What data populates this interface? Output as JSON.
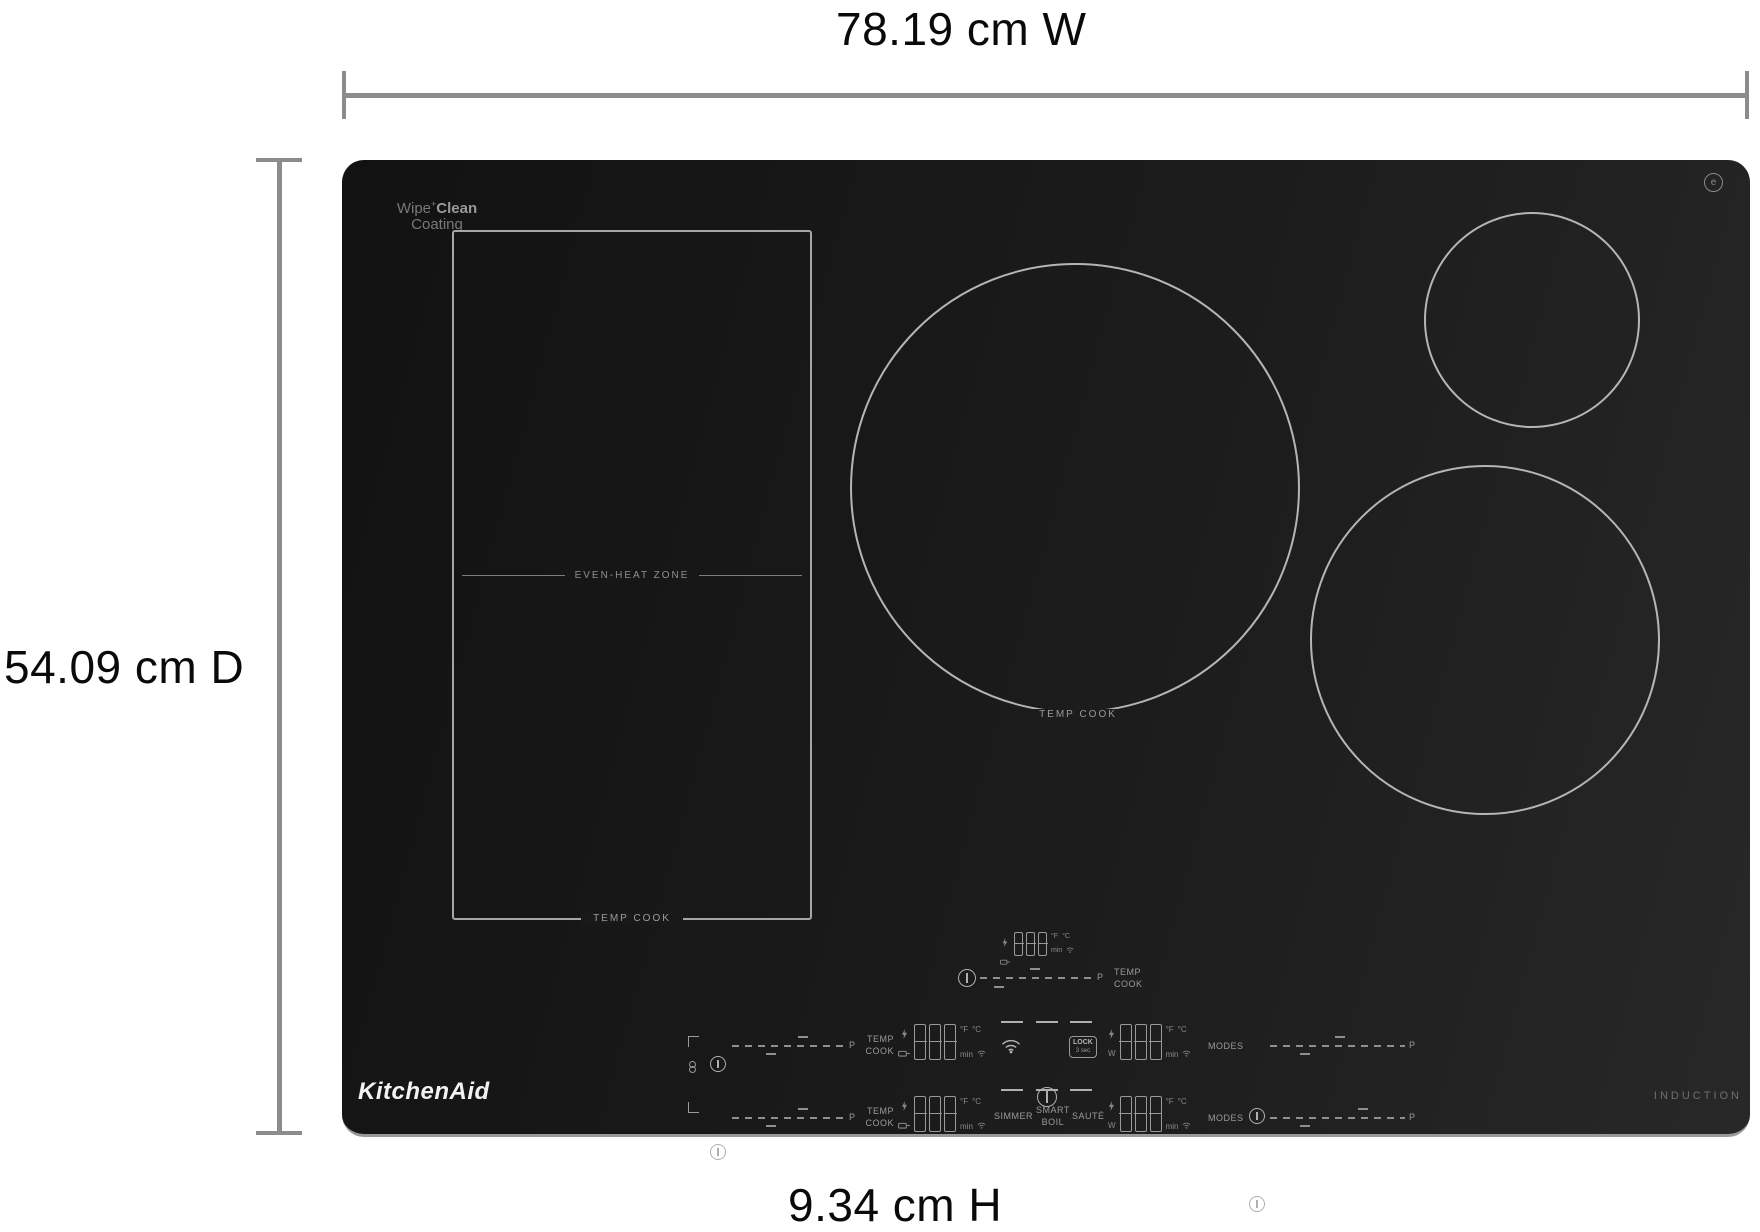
{
  "dimensions": {
    "width_label": "78.19 cm W",
    "depth_label": "54.09 cm D",
    "height_label": "9.34 cm H"
  },
  "branding": {
    "wipe": "Wipe",
    "plus": "+",
    "clean": "Clean",
    "coating": "Coating",
    "brand": "KitchenAid",
    "induction": "INDUCTION",
    "power_clean_glyph": "e"
  },
  "zones": {
    "even_heat_label": "EVEN-HEAT ZONE",
    "even_heat_temp_cook": "TEMP COOK",
    "center_temp_cook": "TEMP COOK"
  },
  "controls": {
    "digits": "888",
    "deg_f": "°F",
    "deg_c": "°C",
    "min": "min",
    "watt": "W",
    "p": "P",
    "temp": "TEMP",
    "cook": "COOK",
    "modes": "MODES",
    "lock": "LOCK",
    "lock_sub": "3 sec",
    "simmer": "SIMMER",
    "smart": "SMART",
    "boil": "BOIL",
    "saute": "SAUTÉ"
  },
  "colors": {
    "surface_dark": "#191919",
    "outline_gray": "#b5b5b5",
    "control_gray": "#9a9a9a",
    "dimension_gray": "#8c8c8c"
  }
}
